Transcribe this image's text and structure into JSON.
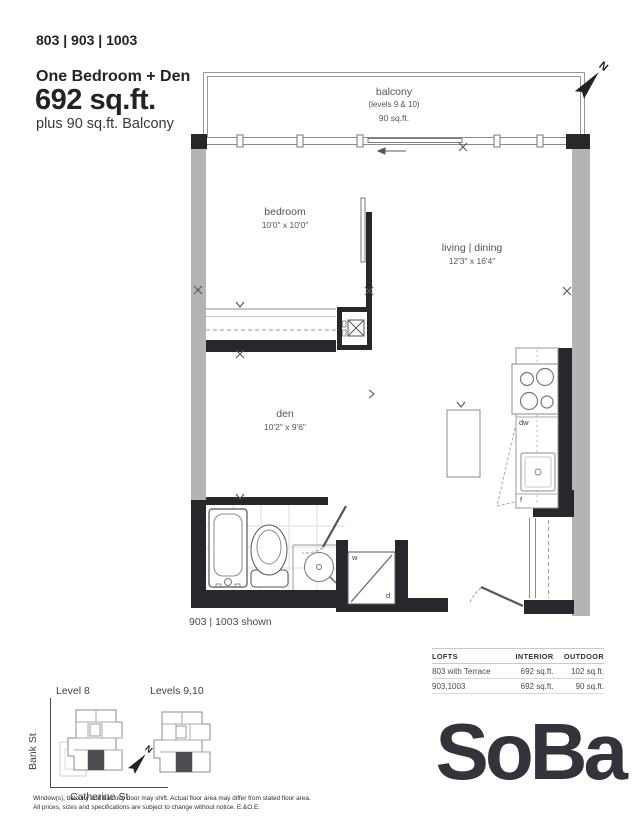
{
  "header": {
    "units": "803 | 903 | 1003",
    "type": "One Bedroom + Den",
    "area": "692 sq.ft.",
    "balcony_note": "plus 90 sq.ft. Balcony"
  },
  "plan": {
    "balcony": {
      "label": "balcony",
      "levels": "(levels 9 & 10)",
      "area": "90 sq.ft."
    },
    "rooms": {
      "bedroom": {
        "label": "bedroom",
        "dims": "10'0\" x 10'0\""
      },
      "living": {
        "label": "living | dining",
        "dims": "12'3\" x 16'4\""
      },
      "den": {
        "label": "den",
        "dims": "10'2\" x 9'6\""
      }
    },
    "labels": {
      "dw": "dw",
      "f": "f",
      "w": "w",
      "d": "d",
      "north": "N"
    },
    "caption": "903 | 1003 shown"
  },
  "table": {
    "headers": [
      "LOFTS",
      "INTERIOR",
      "OUTDOOR"
    ],
    "rows": [
      {
        "loft": "803 with Terrace",
        "interior": "692 sq.ft.",
        "outdoor": "102 sq.ft."
      },
      {
        "loft": "903,1003",
        "interior": "692 sq.ft.",
        "outdoor": "90 sq.ft."
      }
    ]
  },
  "keyplans": {
    "level8": "Level 8",
    "levels910": "Levels 9,10",
    "bank_st": "Bank St",
    "catherine_st": "Catherine St"
  },
  "footer": {
    "disclaimer1": "Window(s), balcony and balcony door may shift. Actual floor area may differ from stated floor area.",
    "disclaimer2": "All prices, sizes and specifications are subject to change without notice. E.&O.E.",
    "logo": "SoBa"
  },
  "colors": {
    "wall": "#28282c",
    "concrete": "#b4b4b5",
    "logo": "#33333b"
  }
}
